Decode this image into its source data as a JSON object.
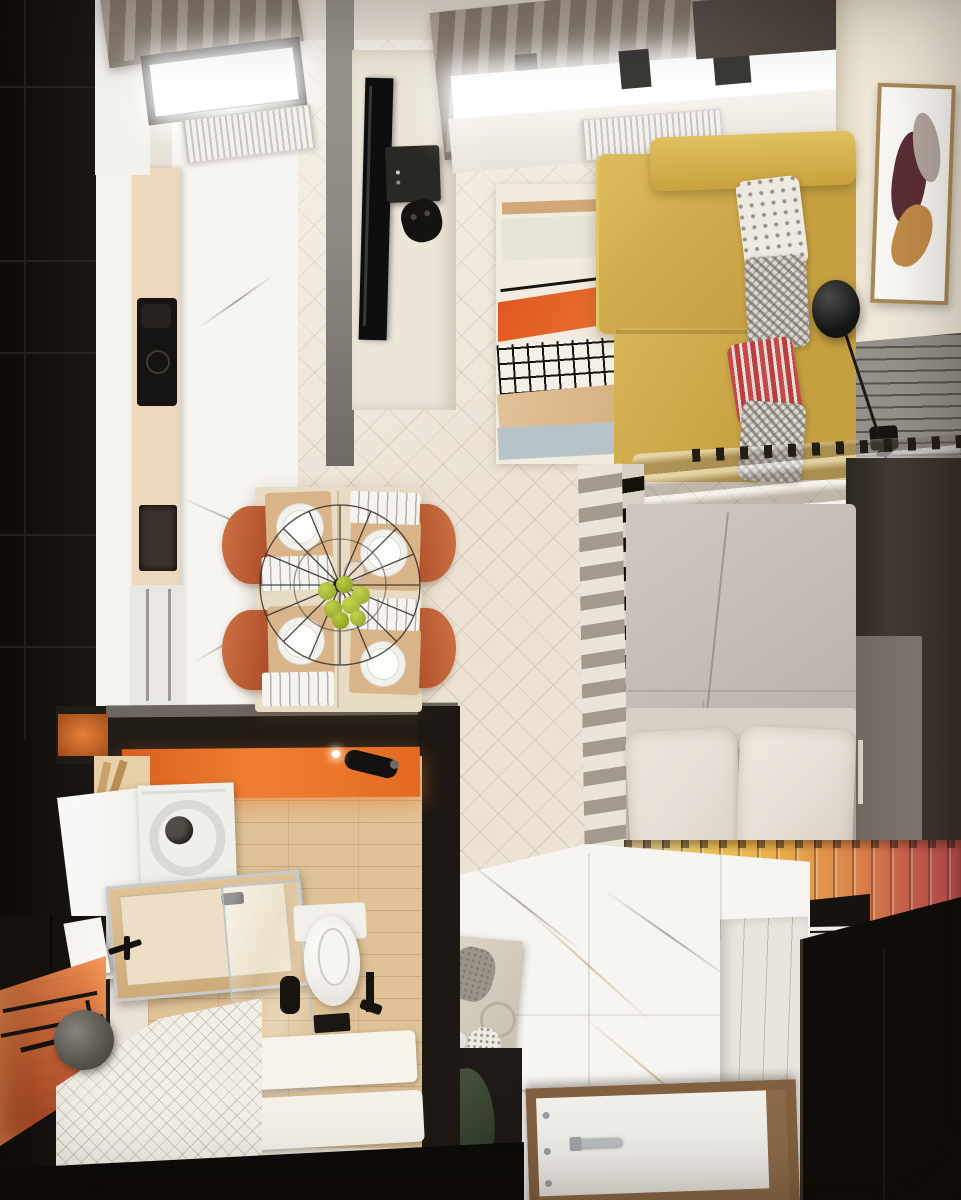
{
  "meta": {
    "title": "Top-down 3D render of a compact studio apartment",
    "type": "architectural interior visualization",
    "view": "bird's-eye plan view, no visible text"
  },
  "palette": {
    "black_unit": "#161310",
    "wall_dark": "#221c16",
    "floor_wood": "#ece3d4",
    "marble_white": "#f7f5f1",
    "counter_beige": "#ecd9bd",
    "cabinet_white": "#f4f2ee",
    "shade_taupe": "#968a7d",
    "partition_gray": "#8e8a83",
    "tv_black": "#0e0e0e",
    "sofa_yellow": "#cfa94b",
    "sofa_yellow_light": "#e0c060",
    "rug_cream": "#f1ebe0",
    "rug_orange": "#e0551e",
    "rug_blue": "#b7c3c9",
    "rug_tan": "#d2a878",
    "chair_terracotta": "#b6572f",
    "table_wood": "#e8ddc4",
    "bed_duvet": "#beb7af",
    "pillow_white": "#e6e0d7",
    "divider_slat": "#eae4d9",
    "roll_gold": "#ecbf52",
    "roll_red": "#c15050",
    "bath_orange": "#e26a22",
    "brick_orange": "#c25d31",
    "bath_wood": "#dfc397",
    "hall_panel": "#e9e5de",
    "closet_black": "#100d0a",
    "door_white": "#efede8",
    "door_frame": "#82603f",
    "frame_wood": "#a98a56",
    "art_maroon": "#5a2f35",
    "art_gold": "#c28c49",
    "ribbed_gray": "#96918b",
    "cream_wall": "#f1e9da",
    "radiator_white": "#f2f1ed",
    "glow_white": "#ffffff"
  },
  "rooms": [
    {
      "name": "kitchen",
      "objects": [
        "tall black shelving unit",
        "white marble floor",
        "beige countertop with black induction cooktop",
        "dark sink",
        "built-in appliances",
        "window with taupe roman shade",
        "white radiator"
      ]
    },
    {
      "name": "living-area",
      "objects": [
        "yellow L-shaped sofa",
        "white floral pillow",
        "two houndstooth pillows",
        "red striped pillow",
        "abstract rug with tan stripe, orange field, black grid and light blue band",
        "dark TV partition with wall-mounted TV",
        "game console and gamepad",
        "window with roman shade",
        "radiator",
        "black sphere floor lamp",
        "framed abstract artwork",
        "gray ribbed wall panel with black outlet"
      ]
    },
    {
      "name": "dining-area",
      "objects": [
        "light wood table set for four",
        "four terracotta half-round chairs",
        "white plates on wooden placemats",
        "cutlery trays",
        "wire cage pendant lamp",
        "bowl of green apples",
        "glasses"
      ]
    },
    {
      "name": "sleeping-area",
      "objects": [
        "white slatted room divider",
        "double bed with warm gray duvet",
        "two white pillows",
        "gray quilted bolster headboard with dark pegs",
        "rolled blanket in cream-yellow-orange-red gradient",
        "dark platform edge",
        "dark wardrobe with recessed door"
      ]
    },
    {
      "name": "bathroom",
      "objects": [
        "black partition walls",
        "glowing orange accent wall with black spotlight",
        "wood-look tile floor",
        "bathtub with chrome rim and glass screen",
        "wall-hung toilet with black brush and paper holder",
        "washing machine seen from above",
        "white storage cabinet",
        "terracotta brick wall with black shower fittings",
        "round gray shower head",
        "white chevron mosaic floor",
        "two white shower mats",
        "small wooden shelf niche"
      ]
    },
    {
      "name": "hallway",
      "objects": [
        "calacatta marble floor with gold veining",
        "white entry door with chrome handle and wooden frame",
        "white paneled wall",
        "black built-in closet",
        "beige console with crystal decor and round trays",
        "dark base cabinet with green bag",
        "slatted side panel"
      ]
    }
  ]
}
